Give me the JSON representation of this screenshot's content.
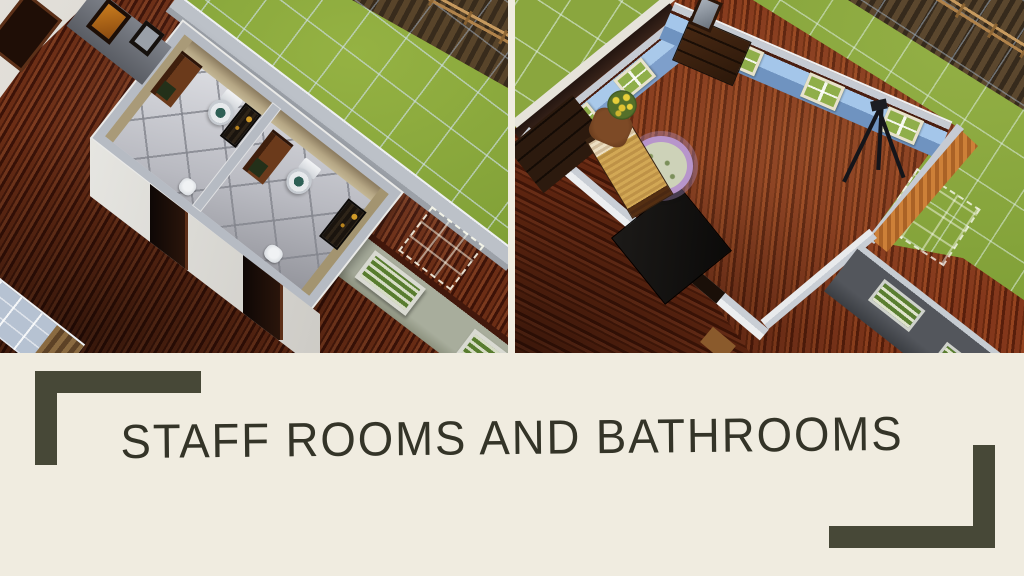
{
  "slide": {
    "title": "STAFF ROOMS AND BATHROOMS"
  },
  "screenshots": {
    "left": {
      "label": "staff-bathrooms-screenshot",
      "description": "Overhead game view of two small staff bathrooms, each with a toilet, wooden vanity counter and dark shower stall, set in a building with dark wood flooring beside a lawn overlaid with a pale build grid, a dirt patch and a rail fence"
    },
    "right": {
      "label": "staff-bedroom-screenshot",
      "description": "Overhead game view of a blue-walled staff bedroom with a bed, round lavender-trimmed rug, yellow flowers on a nightstand, dark dressers with a mirror, and a camera tripod on polished red-brown wood flooring, bordered by lawn, a dirt patch with rail fence and an orange exterior wall"
    }
  },
  "colors": {
    "cream": "#f0ece0",
    "olive": "#474837",
    "ink": "#343428",
    "grass": "#84a139",
    "grassgrid": "#cdddE6",
    "dirt": "#4e3b26",
    "fence": "#b98f55",
    "wooddark": "#5a2310",
    "woodred": "#83371b",
    "tile": "#d6d7db",
    "walltop": "#bcc1c8",
    "walltan": "#b3a482",
    "wallblue": "#9cc0e6",
    "wallorange": "#c27a35",
    "rugpurple": "#b795cb",
    "rugcenter": "#cdd2b8",
    "bedtan": "#d2a855",
    "fixture": "#eceef0"
  }
}
